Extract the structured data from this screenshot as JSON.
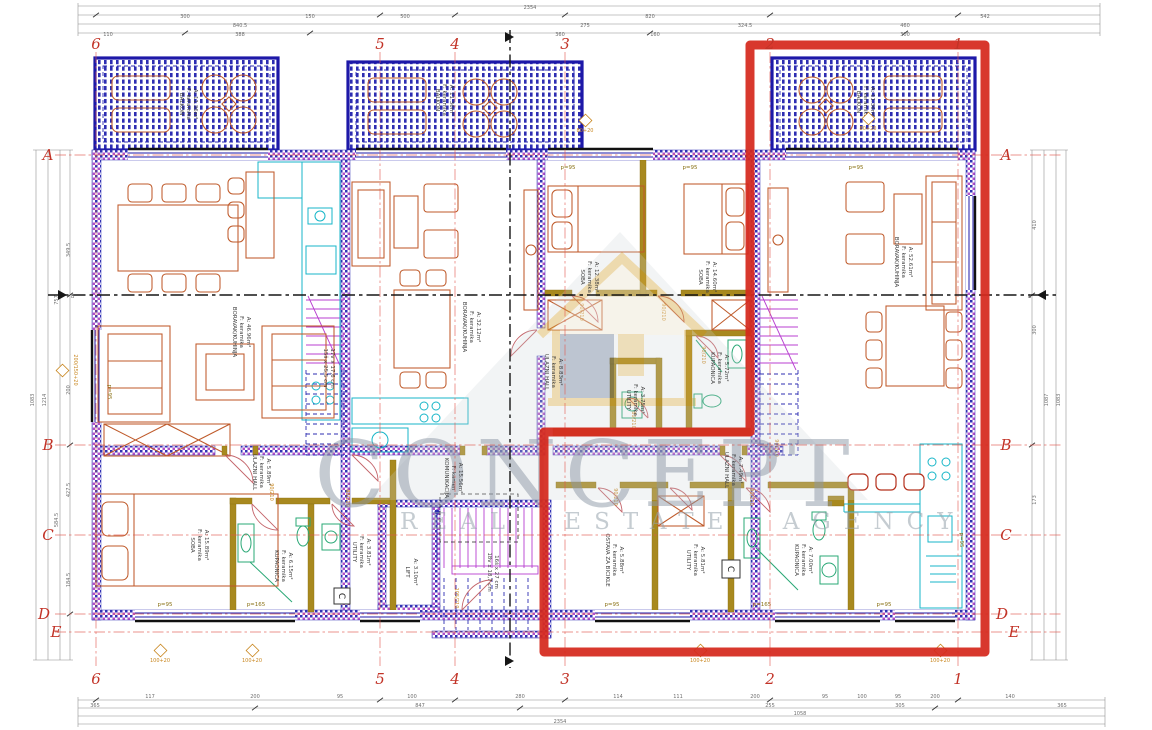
{
  "watermark": {
    "brand": "CONCEPT",
    "tagline": "REAL ESTATE AGENCY"
  },
  "grid": {
    "cols": [
      "6",
      "5",
      "4",
      "3",
      "2",
      "1"
    ],
    "rows": [
      "A",
      "B",
      "C",
      "D",
      "E"
    ],
    "section_label": "B"
  },
  "dims": {
    "top": [
      "2354",
      "840.5",
      "820",
      "300",
      "150",
      "500",
      "542",
      "275",
      "324.5",
      "460",
      "110",
      "388",
      "360",
      "300",
      "160"
    ],
    "bottom": [
      "365",
      "117",
      "200",
      "95",
      "100",
      "280",
      "114",
      "111",
      "200",
      "95",
      "100",
      "95",
      "200",
      "140",
      "847",
      "255",
      "305",
      "365",
      "1058",
      "2354"
    ],
    "left": [
      "349.5",
      "200",
      "427.5",
      "184.5",
      "757",
      "584.5",
      "1214",
      "1083"
    ],
    "right": [
      "410",
      "300",
      "173",
      "1087",
      "1083"
    ]
  },
  "rooms": [
    {
      "name": "BORAVAK/KUHINJA",
      "floor": "F: keramika",
      "area": "A: 46.96m²"
    },
    {
      "name": "SOBA",
      "floor": "F: keramika",
      "area": "A: 15.89m²"
    },
    {
      "name": "ULAZNI HALL",
      "floor": "F: keramika",
      "area": "A: 5.89m²"
    },
    {
      "name": "KUPAONICA",
      "floor": "F: keramika",
      "area": "A: 6.15m²"
    },
    {
      "name": "UTILITY",
      "floor": "F: keramika",
      "area": "A: 3.81m²"
    },
    {
      "name": "KOMUNIKACIJA",
      "floor": "F: kamen",
      "area": "A: 15.56m²"
    },
    {
      "name": "LIFT",
      "floor": "",
      "area": "A: 3.10m²"
    },
    {
      "name": "BORAVAK/KUHINJA",
      "floor": "F: keramika",
      "area": "A: 32.12m²"
    },
    {
      "name": "SOBA",
      "floor": "F: keramika",
      "area": "A: 12.38m²"
    },
    {
      "name": "SOBA",
      "floor": "F: keramika",
      "area": "A: 14.60m²"
    },
    {
      "name": "KUPAONICA",
      "floor": "F: keramika",
      "area": "A: 5.72m²"
    },
    {
      "name": "UTILITY",
      "floor": "F: keramika",
      "area": "A: 3.75m²"
    },
    {
      "name": "ULAZNI HALL",
      "floor": "F: keramika",
      "area": "A: 8.83m²"
    },
    {
      "name": "BORAVAK/KUHINJA",
      "floor": "F: keramika",
      "area": "A: 52.61m²"
    },
    {
      "name": "ULAZNI HALL",
      "floor": "F: keramika",
      "area": "A: 7.49m²"
    },
    {
      "name": "OSTAVA ZA BICIKLE",
      "floor": "F: keramika",
      "area": "A: 5.88m²"
    },
    {
      "name": "UTILITY",
      "floor": "F: keramika",
      "area": "A: 5.81m²"
    },
    {
      "name": "KUPAONICA",
      "floor": "F: keramika",
      "area": "A: 7.00m²"
    }
  ],
  "balconies": [
    {
      "name": "BALKON",
      "floor": "F: keramika",
      "area": "A: 11.36m²"
    },
    {
      "name": "BALKON",
      "floor": "F: keramika",
      "area": "A: 11.36m²"
    },
    {
      "name": "BALKON",
      "floor": "F: keramika",
      "area": "A: 11.36m²"
    }
  ],
  "stairs": {
    "left1": "17v x 17,6 cm",
    "left2": "15š x 25,5 cm",
    "mid1": "16š x 27 cm",
    "mid2": "18v x 18,7 cm"
  },
  "tags": {
    "door_std": "90/210",
    "door_small": "80/210",
    "door_entry": "105/210",
    "window_a": "200/150+20",
    "window_b": "100+20",
    "window_c": "80+20",
    "sill_95": "p=95",
    "sill_165": "p=165",
    "c_box": "C"
  }
}
